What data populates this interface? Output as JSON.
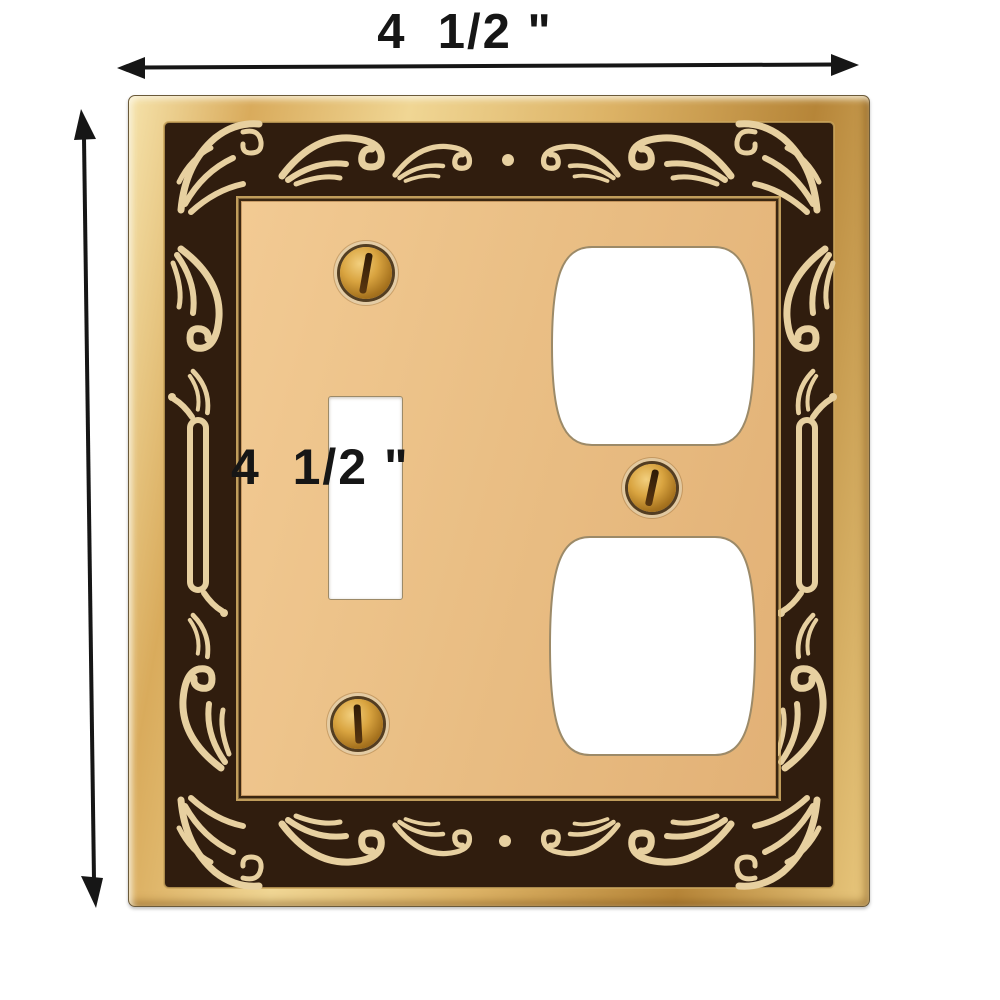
{
  "annotations": {
    "width_label": "4  1/2 \"",
    "height_label": "4  1/2 \""
  },
  "product": {
    "item": "Victorian ornate brass wall plate",
    "openings": [
      "toggle switch",
      "duplex outlet upper",
      "duplex outlet lower"
    ],
    "screw_count": 3
  },
  "icons": {
    "horizontal_arrow": "horizontal-dimension-arrow-icon",
    "vertical_arrow": "vertical-dimension-arrow-icon"
  },
  "colors": {
    "background": "#ffffff",
    "annotation": "#161616",
    "frame_gold_light": "#f6e3ab",
    "frame_gold": "#dcb265",
    "frame_gold_dark": "#b68538",
    "border_dark": "#301d0e",
    "ornament_cream": "#e7d0a0",
    "panel_brass": "#eabf85",
    "screw_brass": "#d9a440"
  }
}
